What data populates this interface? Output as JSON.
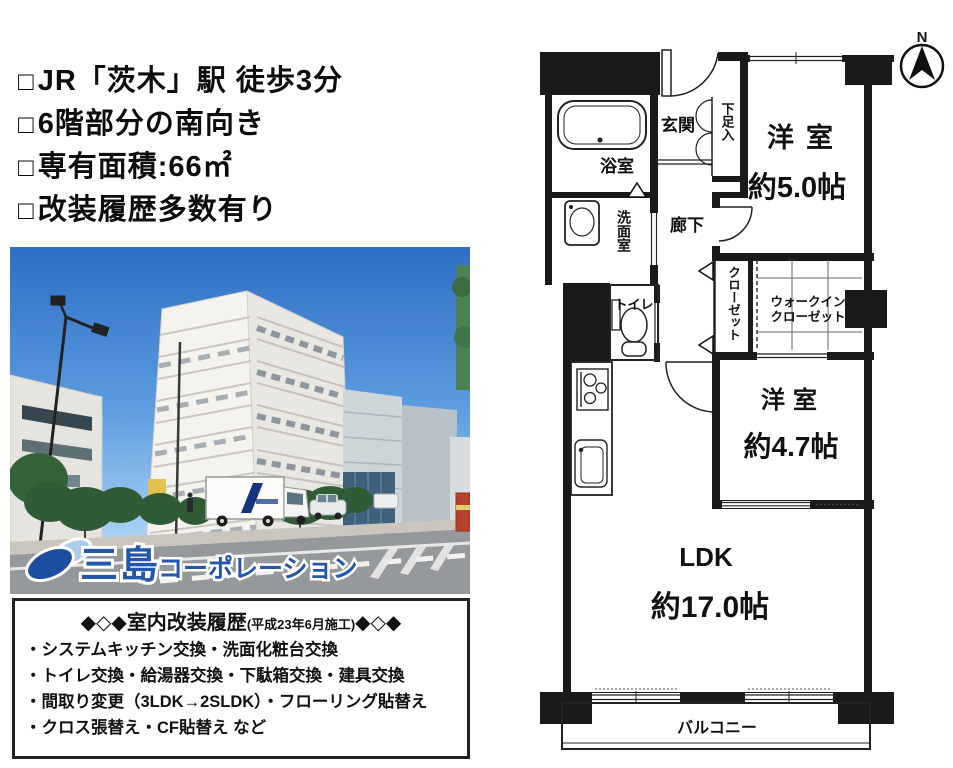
{
  "highlights": {
    "bullet": "□",
    "items": [
      "JR「茨木」駅 徒歩3分",
      "6階部分の南向き",
      "専有面積:66㎡",
      "改装履歴多数有り"
    ]
  },
  "photo": {
    "logo_main": "三島",
    "logo_sub": "コーポレーション",
    "logo_color": "#2456ab"
  },
  "renovation": {
    "diamonds_left": "◆◇◆",
    "title": "室内改装履歴",
    "note": "(平成23年6月施工)",
    "diamonds_right": "◆◇◆",
    "items": [
      "・システムキッチン交換・洗面化粧台交換",
      "・トイレ交換・給湯器交換・下駄箱交換・建具交換",
      "・間取り変更（3LDK→2SLDK）・フローリング貼替え",
      "・クロス張替え・CF貼替え など"
    ]
  },
  "floorplan": {
    "compass": "N",
    "labels": {
      "genkan": "玄関",
      "shoe": "下足入",
      "bath": "浴室",
      "wash": "洗面室",
      "hall": "廊下",
      "toilet": "トイレ",
      "closet": "クローゼット",
      "wic1": "ウォークイン",
      "wic2": "クローゼット",
      "bedroom1_name": "洋室",
      "bedroom1_size": "約5.0帖",
      "bedroom2_name": "洋室",
      "bedroom2_size": "約4.7帖",
      "ldk_name": "LDK",
      "ldk_size": "約17.0帖",
      "balcony": "バルコニー"
    }
  }
}
